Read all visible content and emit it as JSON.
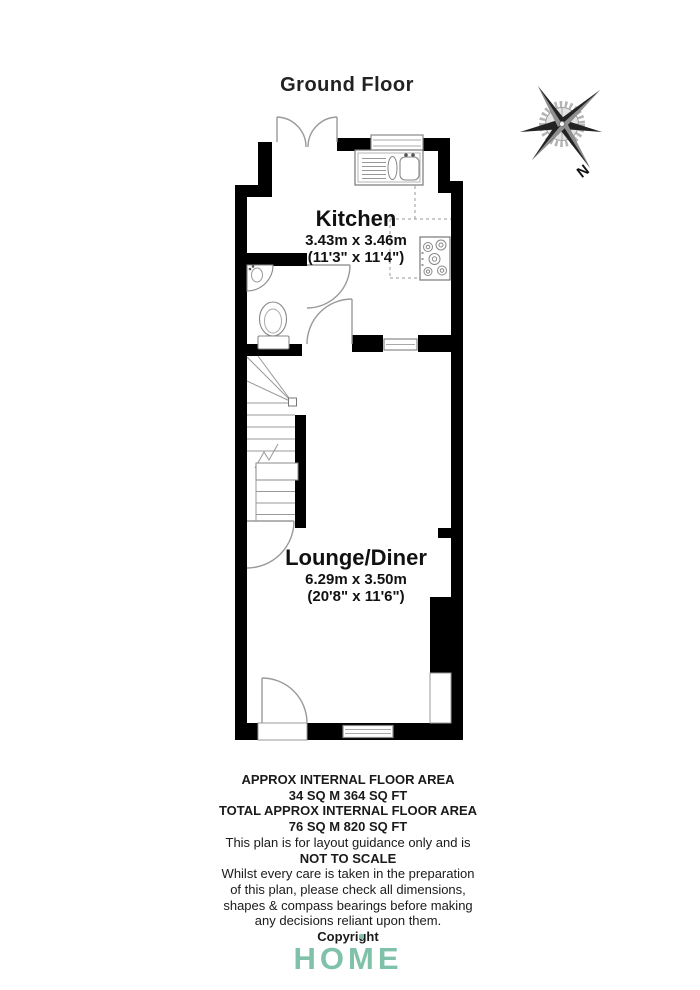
{
  "title": "Ground Floor",
  "compass": {
    "label": "N"
  },
  "rooms": {
    "kitchen": {
      "name": "Kitchen",
      "metric": "3.43m x 3.46m",
      "imperial": "(11'3\" x 11'4\")"
    },
    "lounge": {
      "name": "Lounge/Diner",
      "metric": "6.29m x 3.50m",
      "imperial": "(20'8\" x 11'6\")"
    }
  },
  "footer": {
    "line1": "APPROX INTERNAL FLOOR AREA",
    "line2": "34 SQ M 364 SQ FT",
    "line3": "TOTAL APPROX INTERNAL FLOOR AREA",
    "line4": "76 SQ M 820 SQ FT",
    "line5": "This plan is for layout guidance only and is",
    "line6": "NOT TO SCALE",
    "line7": "Whilst every care is taken in the preparation",
    "line8": "of this plan, please check all dimensions,",
    "line9": "shapes & compass bearings before making",
    "line10": "any decisions reliant upon them.",
    "line11": "Copyright"
  },
  "logo": {
    "part1": "HO",
    "part2": "M",
    "part3": "E",
    "color": "#7fc2a9"
  },
  "colors": {
    "wall": "#000000",
    "fixture_line": "#999999",
    "text": "#1a1a1a",
    "logo_teal": "#7fc2a9"
  }
}
